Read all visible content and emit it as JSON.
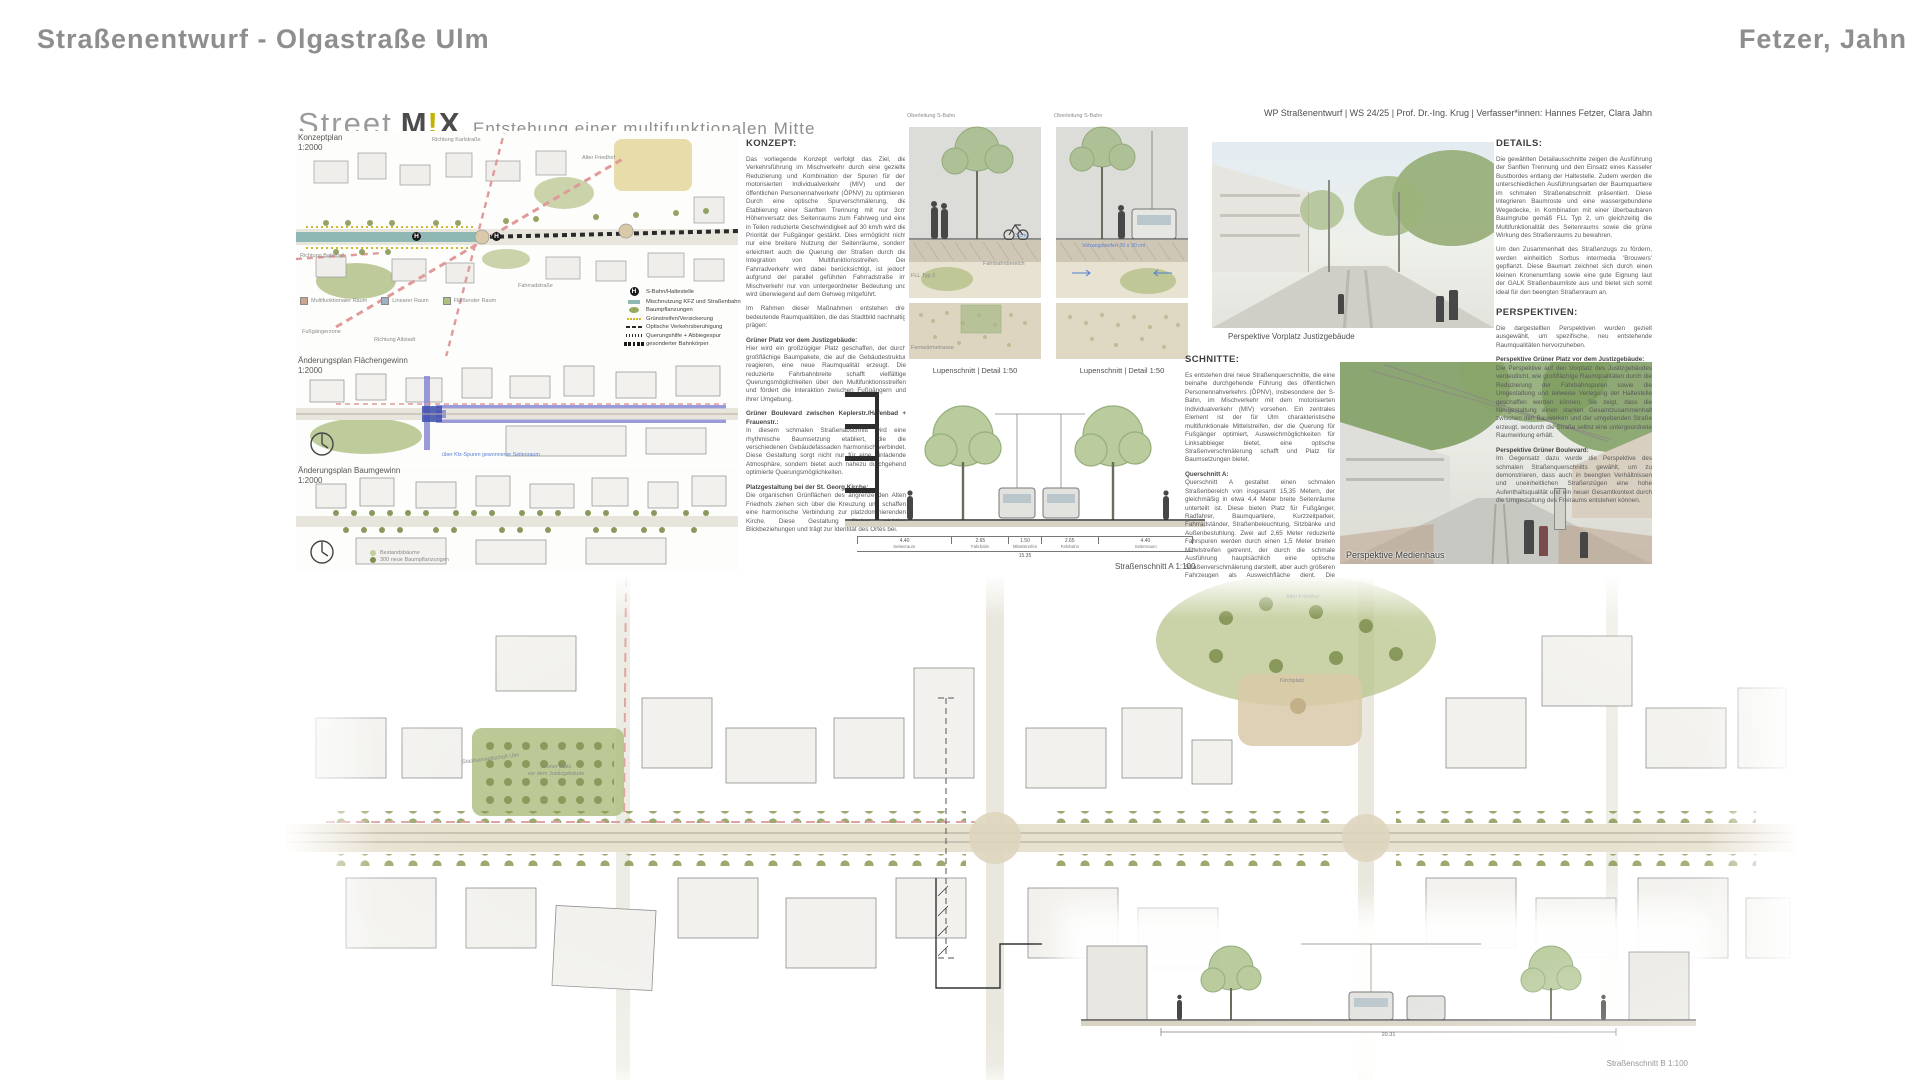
{
  "page": {
    "header_left": "Straßenentwurf - Olgastraße Ulm",
    "header_right": "Fetzer, Jahn"
  },
  "poster": {
    "title": {
      "part1": "Street",
      "logo_m": "M",
      "logo_excl": "!",
      "logo_x": "X",
      "subtitle": "Entstehung einer multifunktionalen Mitte"
    },
    "credit": "WP Straßenentwurf | WS 24/25 | Prof. Dr.-Ing. Krug | Verfasser*innen: Hannes Fetzer, Clara Jahn",
    "maps": {
      "konzeptplan": {
        "title": "Konzeptplan",
        "scale": "1:2000",
        "h_glyph": "H",
        "labels": {
          "richtung_karlstrasse": "Richtung Karlstraße",
          "richtung_bahnhof": "Richtung Bahnhof",
          "fahrradstrasse": "Fahrradstraße",
          "fussgaengerzone": "Fußgängerzone",
          "richtung_altstadt": "Richtung Altstadt",
          "alter_friedhof": "Alter Friedhof"
        },
        "space_types": [
          "Multifunktionaler Raum",
          "Linearer Raum",
          "Fließender Raum"
        ],
        "legend": [
          {
            "icon": "haltestelle-icon",
            "label": "S-Bahn/Haltestelle"
          },
          {
            "icon": "misch-swatch",
            "label": "Mischnutzung KFZ und Straßenbahn"
          },
          {
            "icon": "baum-swatch",
            "label": "Baumpflanzungen"
          },
          {
            "icon": "gruenstreifen-swatch",
            "label": "Grünstreifen/Versickerung"
          },
          {
            "icon": "beruhigung-swatch",
            "label": "Optische Verkehrsberuhigung"
          },
          {
            "icon": "querung-swatch",
            "label": "Querungshilfe + Abbiegespur"
          },
          {
            "icon": "bahnkoerper-swatch",
            "label": "gesonderter Bahnkörper"
          }
        ]
      },
      "flaechengewinn": {
        "title": "Änderungsplan Flächengewinn",
        "scale": "1:2000",
        "note": "über Kfz-Spuren gewonnener Seitenraum"
      },
      "baumgewinn": {
        "title": "Änderungsplan Baumgewinn",
        "scale": "1:2000",
        "legend": [
          "Bestandsbäume",
          "300 neue Baumpflanzungen"
        ]
      },
      "lageplan": {
        "title": "Lageplan",
        "scale": "1:500",
        "labels": {
          "alter_friedhof": "Alter Friedhof",
          "kirchplatz": "Kirchplatz",
          "staatsanwaltschaft": "Staatsanwaltschaft Ulm",
          "gruener_platz_l1": "Grüner Platz",
          "gruener_platz_l2": "vor dem Justizgebäude"
        }
      }
    },
    "lupen": {
      "caption1": "Oberleitung S-Bahn",
      "caption2": "Oberleitung S-Bahn",
      "label1": "Lupenschnitt | Detail 1:50",
      "label2": "Lupenschnitt | Detail 1:50",
      "note_fahrbahn": "Fahrbahnbereich",
      "note_fll": "FLL Typ 2",
      "note_3cm": "3 cm",
      "note_fernwaerme": "Fernwärmetrasse",
      "note_vorrang": "Vorrangstreifen 30 x 30 cm"
    },
    "sections": {
      "schnitt_a_label": "Straßenschnitt A 1:100",
      "schnitt_b_label": "Straßenschnitt B 1:100",
      "dims_a": [
        "4.40",
        "2.65",
        "1.50",
        "2.65",
        "4.40"
      ],
      "dims_a_total": "15.35",
      "dims_b_total": "20.31",
      "zones": [
        "Seitenraum",
        "Fahrbahn",
        "Mittelstreifen",
        "Fahrbahn",
        "Seitenraum"
      ]
    },
    "perspectives": {
      "p1_label": "Perspektive Vorplatz Justizgebäude",
      "p2_label": "Perspektive Medienhaus"
    },
    "text_blocks": {
      "konzept": {
        "heading": "KONZEPT:",
        "p1": "Das vorliegende Konzept verfolgt das Ziel, die Verkehrsführung im Mischverkehr durch eine gezielte Reduzierung und Kombination der Spuren für den motorisierten Individualverkehr (MIV) und den öffentlichen Personennahverkehr (ÖPNV) zu optimieren. Durch eine optische Spurverschmälerung, die Etablierung einer Sanften Trennung mit nur 3cm Höhenversatz des Seitenraums zum Fahrweg und eine in Teilen reduzierte Geschwindigkeit auf 30 km/h wird die Priorität der Fußgänger gestärkt. Dies ermöglicht nicht nur eine breitere Nutzung der Seitenräume, sondern erleichtert auch die Querung der Straßen durch die Integration von Multifunktionsstreifen. Der Fahrradverkehr wird dabei berücksichtigt, ist jedoch aufgrund der parallel geführten Fahrradstraße im Mischverkehr nur von untergeordneter Bedeutung und wird überwiegend auf dem Gehweg mitgeführt.",
        "p2": "Im Rahmen dieser Maßnahmen entstehen drei bedeutende Raumqualitäten, die das Stadtbild nachhaltig prägen:",
        "subs": [
          {
            "head": "Grüner Platz vor dem Justizgebäude:",
            "body": "Hier wird ein großzügiger Platz geschaffen, der durch großflächige Baumpakete, die auf die Gebäudestruktur reagieren, eine neue Raumqualität erzeugt. Die reduzierte Fahrbahnbreite schafft vielfältige Querungsmöglichkeiten über den Multifunktionsstreifen und fördert die Interaktion zwischen Fußgängern und ihrer Umgebung."
          },
          {
            "head": "Grüner Boulevard zwischen Keplerstr./Hafenbad + Frauenstr.:",
            "body": "In diesem schmalen Straßenabschnitt wird eine rhythmische Baumsetzung etabliert, die die verschiedenen Gebäudefassaden harmonisch verbindet. Diese Gestaltung sorgt nicht nur für eine einladende Atmosphäre, sondern bietet auch nahezu durchgehend optimierte Querungsmöglichkeiten."
          },
          {
            "head": "Platzgestaltung bei der St. Georg Kirche:",
            "body": "Die organischen Grünflächen des angrenzenden Alten Friedhofs ziehen sich über die Kreuzung und schaffen eine harmonische Verbindung zur platzdominierenden Kirche. Diese Gestaltung fördert wichtige Blickbeziehungen und trägt zur Identität des Ortes bei."
          }
        ]
      },
      "entwurf": {
        "heading": "ENTWURF:",
        "col1": [
          {
            "head": "Grüner Platz vor dem Justizgebäude:",
            "body": "Der Platz vor dem Justizgebäude wird durch großzügige Rasenflächen und Baumquartiere in eine grüne Oase verwandelt, die das Erlebnis der attraktiven umliegenden Architektur durch geschützte Aufenthaltsbereiche und gezielte Sichtachsen bereichert. Auf der Seite des Schulgebäudes wird die S-Bahn-Haltestelle westlich der Kreuzung integriert, was eine gute Erreichbarkeit von allen Seiten, insbesondere von der Schule aus, gewährleistet."
          },
          {
            "head": "Grüner Boulevard zwischen Keplerstr./Hafenbad + Frauenstr.:",
            "body": "Der beengte Straßenabschnitt erhält einen urbanen Boulevardcharakter, charakterisiert durch rhythmisch angeordnete Aufenthaltsplätze, welche die gleichmäßig rhythmisierte Baumsetzung durchbrechen. Sie sind mit Bänken ausgestattet und als wassergebundene Wegedecke ausgeführt. Auch die Bushaltestelle in Richtung Osten wird direkt nach der Kreuzung integriert."
          }
        ],
        "col2": [
          {
            "head": "Platzgestaltung bei der St. Georg Kirche:",
            "body": "Der die Kreuzung überragende Kirchplatz wird durch begrünte Polygone mit abgerundeten Ecken in einladende Aufenthaltsbereiche unterteilt und erhält durch eine scheinbar zufällige Baumstellung einen organisch fließenden Charakter. Hier entstehen verschiedene Sitzmöglichkeiten, ein Café sowie ein offener Kirchplatz, der Rückzugsmöglichkeiten bietet. Die Materialwahl reagiert harmonisch auf die umgebende Architektur."
          },
          {
            "head": "Straßenanschlüsse:",
            "body": "Alle angrenzenden Straßen werden in einem fußgängerfreundlichen Querschnitt gestaltet, der das Konzept der sanften Trennung aufgreift und die Integration des typischen Ulmer Mittelstreifens berücksichtigt. Die Einbindung eines separaten Radfahrstreifens in der Frauenstraße sowie der Syrlinstraße stellen eine gute Quervernetzung der im Konzept dargestellten Fahrradstraßen dar."
          }
        ]
      },
      "schnitte": {
        "heading": "SCHNITTE:",
        "p1": "Es entstehen drei neue Straßenquerschnitte, die eine beinahe durchgehende Führung des öffentlichen Personennahverkehrs (ÖPNV), insbesondere der S-Bahn, im Mischverkehr mit dem motorisierten Individualverkehr (MIV) vorsehen. Ein zentrales Element ist der für Ulm charakteristische multifunktionale Mittelstreifen, der die Querung für Fußgänger optimiert, Ausweichmöglichkeiten für Linksabbieger bietet, eine optische Straßenverschmälerung schafft und Platz für Baumsetzungen bietet.",
        "subs": [
          {
            "head": "Querschnitt A:",
            "body": "Querschnitt A gestaltet einen schmalen Straßenbereich von insgesamt 15,35 Metern, der gleichmäßig in etwa 4,4 Meter breite Seitenräume unterteilt ist. Diese bieten Platz für Fußgänger, Radfahrer, Baumquartiere, Kurzzeitparker, Fahrradständer, Straßenbeleuchtung, Sitzbänke und Außenbestuhlung. Zwei auf 2,65 Meter reduzierte Fahrspuren werden durch einen 1,5 Meter breiten Mittelstreifen getrennt, der durch die schmale Ausführung hauptsächlich eine optische Straßenverschmälerung darstellt, aber auch größeren Fahrzeugen als Ausweichfläche dient. Die Bushaltestelle in Richtung Osten nutzt die Kolonnaden des angrenzenden Gebäudes als Unterstand und erzeugt durch die Anordnung nach der Kreuzung eine Pulkführung im folgenden Straßenabschnitt."
          },
          {
            "head": "Querschnitt B:",
            "body": "Querschnitt B zeigt einen 20,31 Meter breiten Straßenraum, der einen großzügigen Kirchvorplatz schafft. Hier sind drei Fahrspuren untergebracht, wobei eine separate Abbiegespur die Priorisierung der S-Bahn unterstützt. In Richtung der König-Wilhelm-Straße und Münchner Straße ermöglicht die Umgestaltung zudem eine separate S-Bahnspur, die sich als Linksabbiegespur im Mischverkehr ausbildet."
          }
        ],
        "p_last": "Ein dritter Querschnitt im Bereich des Justizgebäudes ähnelt stark Querschnitt A. Hier wird der großzügige Straßenraum genutzt, um den Mittelstreifen und die Fahrspuren auf jeweils 3 Meter zu verbreitern, wodurch die Multifunktionalität des Mittelstreifens als separate Abbiegespur und für die Integration von Straßenbäumen erhöht wird."
      },
      "details": {
        "heading": "DETAILS:",
        "p1": "Die gewählten Detailausschnitte zeigen die Ausführung der Sanften Trennung und den Einsatz eines Kasseler Bustbordes entlang der Haltestelle. Zudem werden die unterschiedlichen Ausführungsarten der Baumquartiere im schmalen Straßenabschnitt präsentiert. Diese integrieren Baumroste und eine wassergebundene Wegedecke, in Kombination mit einer überbaubaren Baumgrube gemäß FLL Typ 2, um gleichzeitig die Multifunktionalität des Seitenraums sowie die grüne Wirkung des Straßenraums zu bewahren.",
        "p2": "Um den Zusammenhalt des Straßenzugs zu fördern, werden einheitlich Sorbus intermedia 'Brouwers' gepflanzt. Diese Baumart zeichnet sich durch einen kleinen Kronenumfang sowie eine gute Eignung laut der GALK Straßenbaumliste aus und bietet sich somit ideal für den beengten Straßenraum an."
      },
      "perspektiven": {
        "heading": "PERSPEKTIVEN:",
        "p1": "Die dargestellten Perspektiven wurden gezielt ausgewählt, um spezifische, neu entstehende Raumqualitäten hervorzuheben.",
        "subs": [
          {
            "head": "Perspektive Grüner Platz vor dem Justizgebäude:",
            "body": "Die Perspektive auf den Vorplatz des Justizgebäudes verdeutlicht, wie großflächige Raumqualitäten durch die Reduzierung der Fahrbahnspuren sowie die Umgestaltung und teilweise Verlegung der Haltestelle geschaffen werden können. Sie zeigt, dass die Neugestaltung einen starken Gesamtzusammenhalt zwischen den Bauwerken und der umgebenden Straße erzeugt, wodurch die Straße selbst eine untergeordnete Raumwirkung erhält."
          },
          {
            "head": "Perspektive Grüner Boulevard:",
            "body": "Im Gegensatz dazu wurde die Perspektive des schmalen Straßenquerschnitts gewählt, um zu demonstrieren, dass auch in beengten Verhältnissen und uneinheitlichen Straßenzügen eine hohe Aufenthaltsqualität und ein neuer Gesamtkontext durch die Umgestaltung des Freiraums entstehen können."
          }
        ]
      }
    }
  },
  "colors": {
    "header_gray": "#8e8e8e",
    "logo_accent": "#c3b200",
    "tram_teal": "#8fb8b4",
    "green_area": "#aebf84",
    "tree_green": "#8a9a55",
    "street_beige": "#e7e1d0",
    "pink_route": "#e09a9a",
    "plan_purple": "#7b7bd0",
    "note_blue": "#5b7fd4"
  }
}
